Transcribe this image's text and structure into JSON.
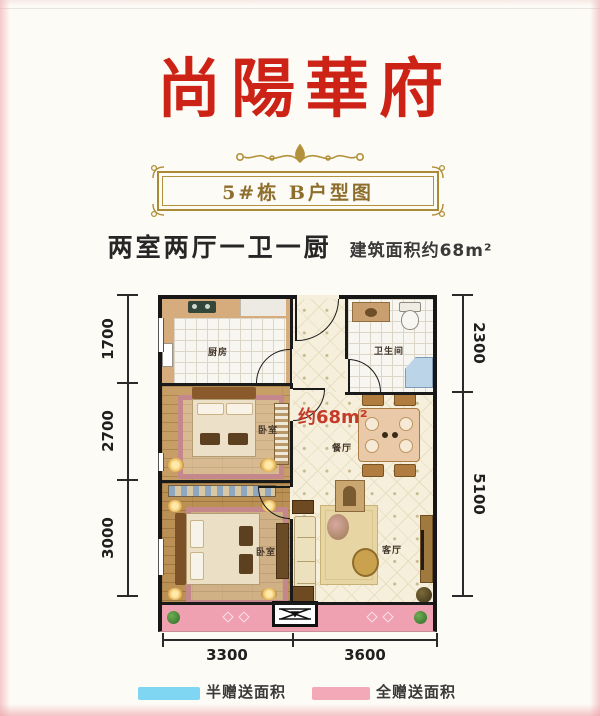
{
  "header": {
    "title": "尚陽華府",
    "banner": "5#栋  B户型图",
    "layout_text": "两室两厅一卫一厨",
    "area_text": "建筑面积约68m²"
  },
  "floorplan": {
    "area_label": "约68m²",
    "rooms": {
      "kitchen": "厨房",
      "bathroom": "卫生间",
      "bedroom1": "卧室",
      "bedroom2": "卧室",
      "dining": "餐厅",
      "living": "客厅"
    },
    "dimensions": {
      "left": [
        "1700",
        "2700",
        "3000"
      ],
      "right": [
        "2300",
        "5100"
      ],
      "bottom": [
        "3300",
        "3600"
      ]
    }
  },
  "legend": {
    "items": [
      {
        "label": "半赠送面积",
        "color": "#7fd6f3"
      },
      {
        "label": "全赠送面积",
        "color": "#f4a9b8"
      }
    ]
  },
  "colors": {
    "title_red": "#cd2316",
    "frame_gold": "#ab8a35",
    "balcony_pink": "#f0a1b1",
    "area_label_red": "#c43b2a",
    "wall_black": "#1a1a1a"
  }
}
